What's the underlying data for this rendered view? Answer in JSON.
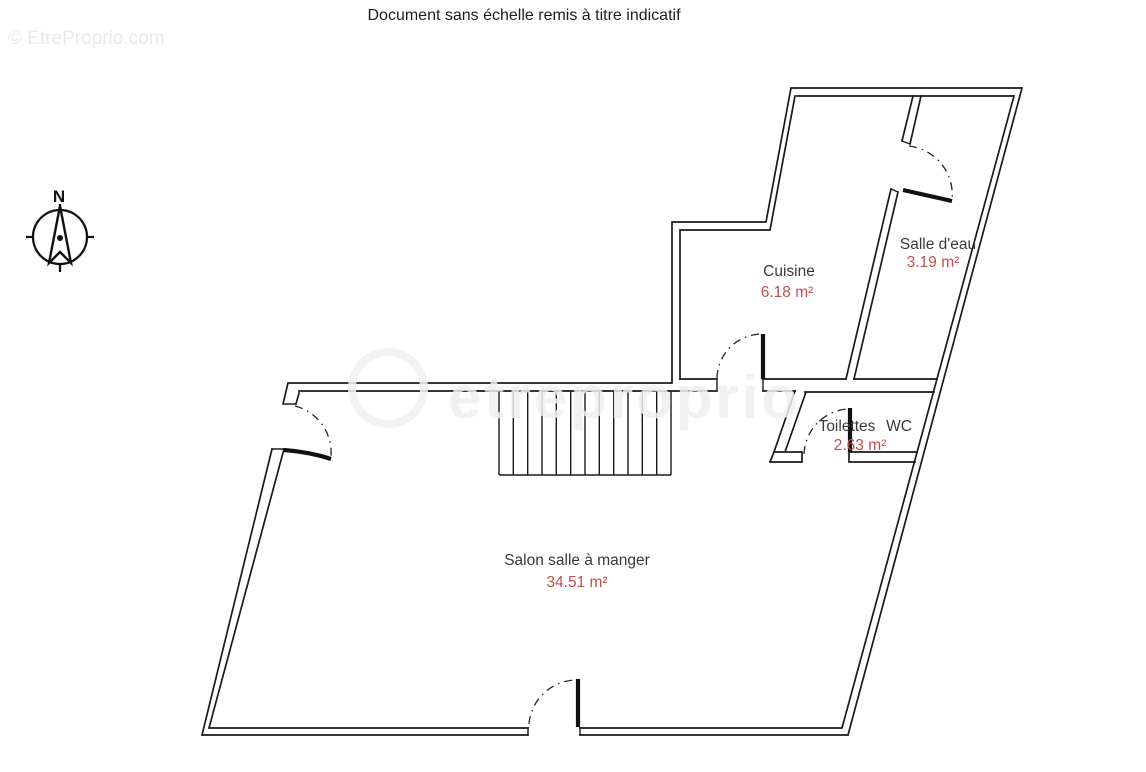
{
  "title": "Document sans échelle remis à titre indicatif",
  "watermark": {
    "corner": "© EtreProprio.com",
    "center": "etreproprio"
  },
  "compass": {
    "north_label": "N"
  },
  "rooms": [
    {
      "name": "Cuisine",
      "area": "6.18 m²"
    },
    {
      "name": "Salle d'eau",
      "area": "3.19 m²"
    },
    {
      "name": "Toilettes",
      "name_extra": "WC",
      "area": "2.63 m²"
    },
    {
      "name": "Salon salle à manger",
      "area": "34.51 m²"
    }
  ],
  "colors": {
    "walls": "#1a1a1a",
    "room_name_text": "#3a3a3a",
    "area_text": "#c0504d",
    "watermark_text": "#e9e9e9"
  }
}
